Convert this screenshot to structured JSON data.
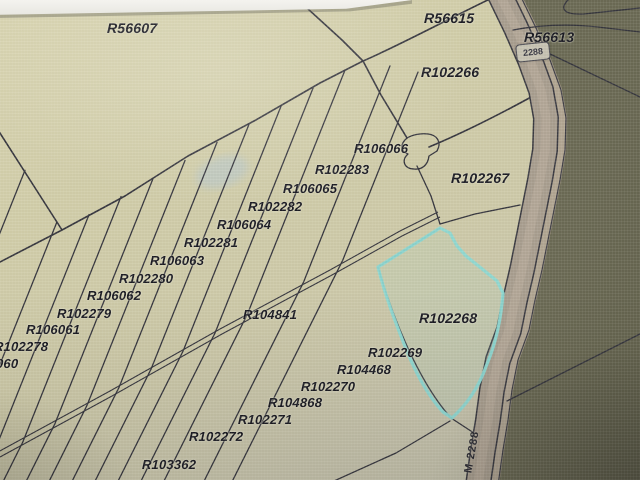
{
  "map": {
    "selected_parcel": "R102268",
    "road": {
      "shield": "2288",
      "name_label": "M 2288"
    },
    "parcel_labels": [
      {
        "text": "R56607",
        "x": 107,
        "y": 20,
        "size": 14
      },
      {
        "text": "R56615",
        "x": 424,
        "y": 10,
        "size": 14
      },
      {
        "text": "R56613",
        "x": 524,
        "y": 29,
        "size": 14
      },
      {
        "text": "R102266",
        "x": 421,
        "y": 64,
        "size": 14
      },
      {
        "text": "R106066",
        "x": 354,
        "y": 141,
        "size": 13
      },
      {
        "text": "R102283",
        "x": 315,
        "y": 162,
        "size": 13
      },
      {
        "text": "R102267",
        "x": 451,
        "y": 170,
        "size": 14
      },
      {
        "text": "R106065",
        "x": 283,
        "y": 181,
        "size": 13
      },
      {
        "text": "R102282",
        "x": 248,
        "y": 199,
        "size": 13
      },
      {
        "text": "R106064",
        "x": 217,
        "y": 217,
        "size": 13
      },
      {
        "text": "R102281",
        "x": 184,
        "y": 235,
        "size": 13
      },
      {
        "text": "R106063",
        "x": 150,
        "y": 253,
        "size": 13
      },
      {
        "text": "R102280",
        "x": 119,
        "y": 271,
        "size": 13
      },
      {
        "text": "R106062",
        "x": 87,
        "y": 288,
        "size": 13
      },
      {
        "text": "R102279",
        "x": 57,
        "y": 306,
        "size": 13
      },
      {
        "text": "R106061",
        "x": 26,
        "y": 322,
        "size": 13
      },
      {
        "text": "R102278",
        "x": -6,
        "y": 339,
        "size": 13
      },
      {
        "text": "060",
        "x": -4,
        "y": 356,
        "size": 13
      },
      {
        "text": "R104841",
        "x": 243,
        "y": 307,
        "size": 13
      },
      {
        "text": "R102268",
        "x": 419,
        "y": 310,
        "size": 14
      },
      {
        "text": "R102269",
        "x": 368,
        "y": 345,
        "size": 13
      },
      {
        "text": "R104468",
        "x": 337,
        "y": 362,
        "size": 13
      },
      {
        "text": "R102270",
        "x": 301,
        "y": 379,
        "size": 13
      },
      {
        "text": "R104868",
        "x": 268,
        "y": 395,
        "size": 13
      },
      {
        "text": "R102271",
        "x": 238,
        "y": 412,
        "size": 13
      },
      {
        "text": "R102272",
        "x": 189,
        "y": 429,
        "size": 13
      },
      {
        "text": "R103362",
        "x": 142,
        "y": 457,
        "size": 13
      }
    ],
    "colors": {
      "parcel_line": "#35353d",
      "highlight": "#8dd8d2",
      "road_fill": "#a89d8e",
      "road_center": "#b9ac9b",
      "road_band": "#ac9f8d",
      "dark_area": "#6b6a54",
      "dark_area_deep": "#62614c",
      "map_bg": "#cdc9a8",
      "label_text": "#1a1a22",
      "shield_bg": "#c6c2b2"
    }
  }
}
